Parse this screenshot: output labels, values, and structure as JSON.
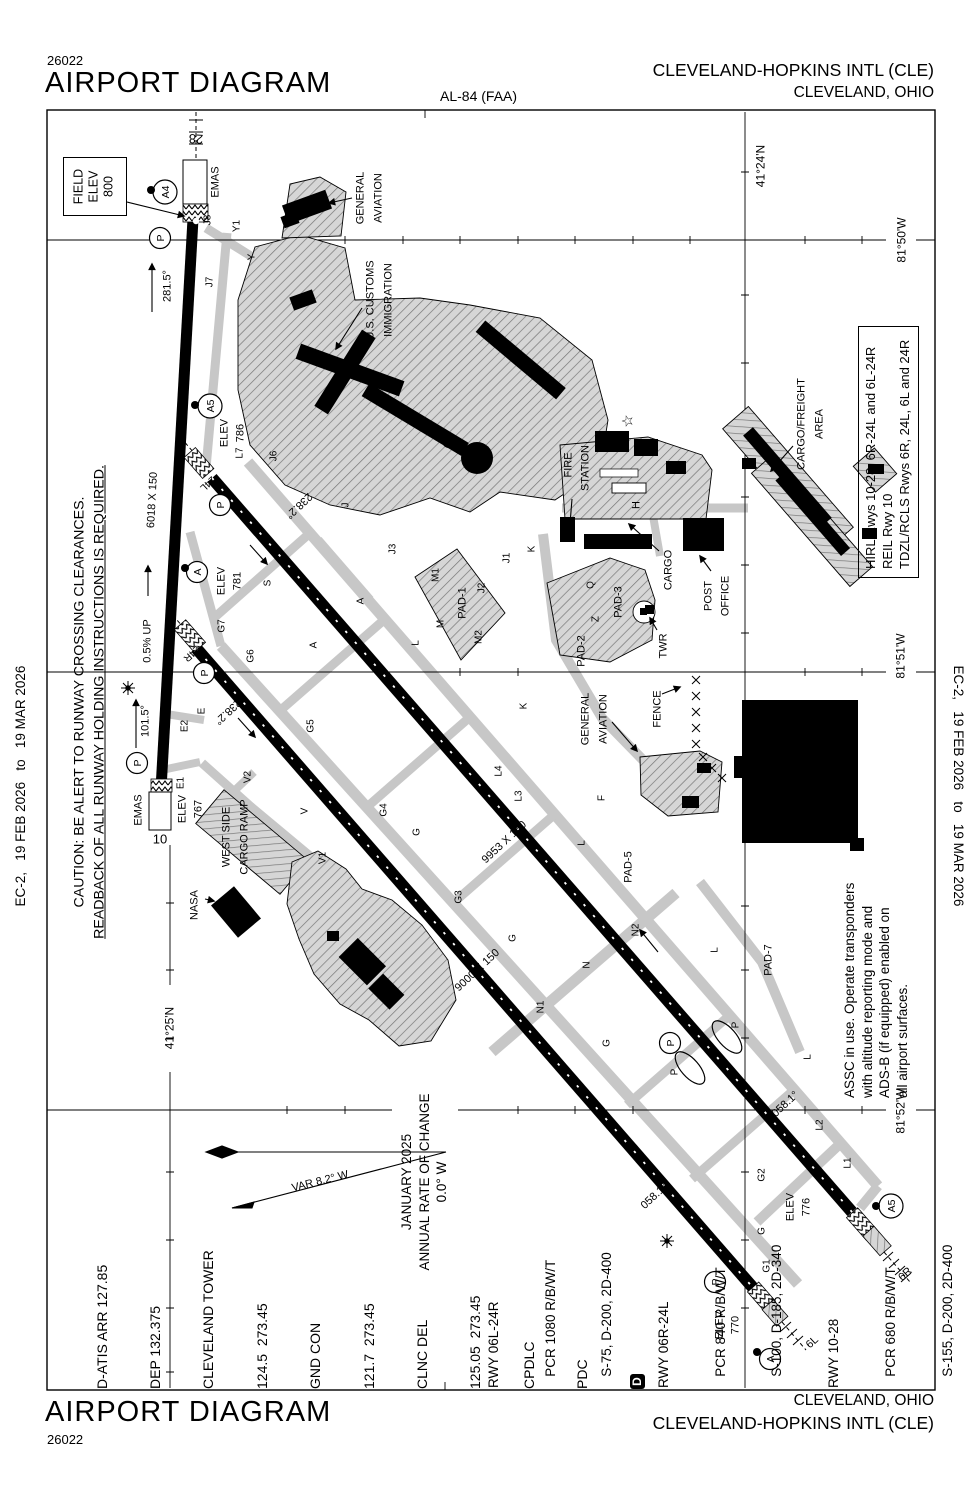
{
  "header": {
    "cycle": "26022",
    "title": "AIRPORT DIAGRAM",
    "chart_code": "AL-84 (FAA)",
    "airport_name": "CLEVELAND-HOPKINS INTL (CLE)",
    "city": "CLEVELAND, OHIO"
  },
  "footer": {
    "title": "AIRPORT DIAGRAM",
    "cycle": "26022",
    "city": "CLEVELAND, OHIO",
    "airport_name": "CLEVELAND-HOPKINS INTL (CLE)"
  },
  "margins": {
    "left": "EC-2,   19 FEB 2026   to   19 MAR 2026",
    "right": "EC-2,   19 FEB 2026   to   19 MAR 2026"
  },
  "caution": {
    "line1": "CAUTION: BE ALERT TO RUNWAY CROSSING CLEARANCES.",
    "line2": "READBACK OF ALL RUNWAY HOLDING INSTRUCTIONS IS REQUIRED."
  },
  "field_elev": {
    "line1": "FIELD",
    "line2": "ELEV",
    "value": "800"
  },
  "comm": {
    "lines": [
      "D-ATIS ARR 127.85",
      "DEP 132.375",
      "CLEVELAND TOWER",
      "124.5  273.45",
      "GND CON",
      "121.7  273.45",
      "CLNC DEL",
      "125.05  273.45",
      "CPDLC",
      "PDC"
    ],
    "pdc_symbol": "D"
  },
  "runway_data": {
    "lines": [
      "RWY 06L-24R",
      "   PCR 1080 R/B/W/T",
      "   S-75, D-200, 2D-400",
      "RWY 06R-24L",
      "   PCR 840 R/B/W/T",
      "   S-100, D-185, 2D-340",
      "RWY 10-28",
      "   PCR 680 R/B/W/T",
      "   S-155, D-200, 2D-400"
    ]
  },
  "lighting_box": {
    "lines": [
      "HIRL Rwys 10-28, 6R-24L and 6L-24R",
      "REIL Rwy 10",
      "TDZL/RCLS Rwys 6R, 24L, 6L and 24R"
    ]
  },
  "assc_note": {
    "lines": [
      "ASSC in use. Operate transponders",
      "with altitude reporting mode and",
      "ADS-B (if equipped) enabled on",
      "all airport surfaces."
    ]
  },
  "variation": {
    "january": "JANUARY 2025",
    "rate": "ANNUAL RATE OF CHANGE",
    "value": "0.0° W"
  },
  "map": {
    "labels": [
      {
        "n": "rwy-28-number",
        "t": "28",
        "x": 196,
        "y": 138,
        "r": 183,
        "s": 13
      },
      {
        "n": "emas-28-label",
        "t": "EMAS",
        "x": 215,
        "y": 182,
        "r": -90,
        "s": 11
      },
      {
        "t": "J8",
        "x": 207,
        "y": 220,
        "r": -90,
        "s": 10
      },
      {
        "t": "Y1",
        "x": 236,
        "y": 226,
        "r": -90,
        "s": 10
      },
      {
        "t": "Y",
        "x": 251,
        "y": 257,
        "r": -90,
        "s": 10
      },
      {
        "t": "J7",
        "x": 209,
        "y": 282,
        "r": -90,
        "s": 10
      },
      {
        "n": "rwy-28-heading",
        "t": "281.5°",
        "x": 167,
        "y": 286,
        "r": -90,
        "s": 11
      },
      {
        "t": "GENERAL",
        "x": 360,
        "y": 198,
        "r": -90,
        "s": 11
      },
      {
        "t": "AVIATION",
        "x": 378,
        "y": 198,
        "r": -90,
        "s": 11
      },
      {
        "t": "U.S. CUSTOMS",
        "x": 370,
        "y": 300,
        "r": -90,
        "s": 11
      },
      {
        "t": "IMMIGRATION",
        "x": 388,
        "y": 300,
        "r": -90,
        "s": 11
      },
      {
        "n": "lat-41-24",
        "t": "41°24'N",
        "x": 761,
        "y": 166,
        "r": -90,
        "s": 12
      },
      {
        "n": "lon-81-50",
        "t": "81°50'W",
        "x": 902,
        "y": 240,
        "r": -90,
        "s": 12
      },
      {
        "t": "ELEV",
        "x": 224,
        "y": 433,
        "r": -90,
        "s": 11
      },
      {
        "t": "786",
        "x": 240,
        "y": 433,
        "r": -90,
        "s": 11
      },
      {
        "t": "L7",
        "x": 239,
        "y": 453,
        "r": -90,
        "s": 10
      },
      {
        "n": "rwy-24l-number",
        "t": "24L",
        "x": 208,
        "y": 484,
        "r": 137,
        "s": 10
      },
      {
        "t": "J6",
        "x": 273,
        "y": 456,
        "r": -90,
        "s": 10
      },
      {
        "t": "J",
        "x": 345,
        "y": 505,
        "r": -90,
        "s": 10
      },
      {
        "t": "J3",
        "x": 392,
        "y": 549,
        "r": -90,
        "s": 10
      },
      {
        "t": "J1",
        "x": 506,
        "y": 558,
        "r": -90,
        "s": 10
      },
      {
        "t": "J2",
        "x": 481,
        "y": 588,
        "r": -90,
        "s": 10
      },
      {
        "t": "K",
        "x": 531,
        "y": 549,
        "r": -90,
        "s": 10
      },
      {
        "t": "K",
        "x": 523,
        "y": 706,
        "r": -90,
        "s": 10
      },
      {
        "t": "M1",
        "x": 435,
        "y": 575,
        "r": -90,
        "s": 10
      },
      {
        "t": "PAD-1",
        "x": 462,
        "y": 603,
        "r": -90,
        "s": 11
      },
      {
        "t": "M",
        "x": 440,
        "y": 624,
        "r": -90,
        "s": 10
      },
      {
        "t": "M2",
        "x": 478,
        "y": 637,
        "r": -90,
        "s": 10
      },
      {
        "t": "L",
        "x": 415,
        "y": 643,
        "r": -90,
        "s": 10
      },
      {
        "n": "rwy-24l-heading",
        "t": "238.2°",
        "x": 299,
        "y": 506,
        "r": 137,
        "s": 11
      },
      {
        "t": "S",
        "x": 267,
        "y": 583,
        "r": -90,
        "s": 10
      },
      {
        "t": "ELEV",
        "x": 221,
        "y": 581,
        "r": -90,
        "s": 11
      },
      {
        "t": "781",
        "x": 237,
        "y": 581,
        "r": -90,
        "s": 11
      },
      {
        "t": "A",
        "x": 313,
        "y": 645,
        "r": -90,
        "s": 10
      },
      {
        "t": "A",
        "x": 360,
        "y": 601,
        "r": -90,
        "s": 10
      },
      {
        "t": "G7",
        "x": 221,
        "y": 626,
        "r": -90,
        "s": 10
      },
      {
        "n": "rwy-24r-number",
        "t": "24R",
        "x": 192,
        "y": 654,
        "r": 137,
        "s": 10
      },
      {
        "t": "G6",
        "x": 250,
        "y": 656,
        "r": -90,
        "s": 10
      },
      {
        "t": "E2",
        "x": 184,
        "y": 726,
        "r": -90,
        "s": 10
      },
      {
        "t": "E",
        "x": 201,
        "y": 711,
        "r": -90,
        "s": 10
      },
      {
        "n": "rwy-24r-heading",
        "t": "238.2°",
        "x": 228,
        "y": 712,
        "r": 137,
        "s": 11
      },
      {
        "t": "G5",
        "x": 310,
        "y": 726,
        "r": -90,
        "s": 10
      },
      {
        "n": "slope-label",
        "t": "0.5% UP",
        "x": 147,
        "y": 641,
        "r": -90,
        "s": 11
      },
      {
        "n": "rwy-10-heading",
        "t": "101.5°",
        "x": 145,
        "y": 721,
        "r": -90,
        "s": 11
      },
      {
        "t": "E1",
        "x": 180,
        "y": 783,
        "r": -90,
        "s": 10
      },
      {
        "n": "emas-10-label",
        "t": "EMAS",
        "x": 138,
        "y": 810,
        "r": -90,
        "s": 11
      },
      {
        "n": "rwy-10-number",
        "t": "10",
        "x": 160,
        "y": 840,
        "r": 0,
        "s": 13
      },
      {
        "t": "ELEV",
        "x": 182,
        "y": 809,
        "r": -90,
        "s": 11
      },
      {
        "t": "767",
        "x": 198,
        "y": 809,
        "r": -90,
        "s": 11
      },
      {
        "t": "V2",
        "x": 247,
        "y": 777,
        "r": -90,
        "s": 10
      },
      {
        "t": "WEST SIDE",
        "x": 226,
        "y": 837,
        "r": -90,
        "s": 11
      },
      {
        "t": "CARGO RAMP",
        "x": 244,
        "y": 837,
        "r": -90,
        "s": 11
      },
      {
        "t": "V",
        "x": 304,
        "y": 811,
        "r": -90,
        "s": 10
      },
      {
        "t": "V1",
        "x": 322,
        "y": 858,
        "r": -90,
        "s": 10
      },
      {
        "t": "NASA",
        "x": 194,
        "y": 905,
        "r": -90,
        "s": 11
      },
      {
        "n": "lat-41-25",
        "t": "41°25'N",
        "x": 170,
        "y": 1028,
        "r": -90,
        "s": 12
      },
      {
        "t": "G4",
        "x": 383,
        "y": 810,
        "r": -90,
        "s": 10
      },
      {
        "t": "G",
        "x": 416,
        "y": 832,
        "r": -90,
        "s": 10
      },
      {
        "t": "G3",
        "x": 458,
        "y": 897,
        "r": -90,
        "s": 10
      },
      {
        "t": "G",
        "x": 512,
        "y": 938,
        "r": -90,
        "s": 10
      },
      {
        "n": "rwy-6l24r-dim",
        "t": "9000 X 150",
        "x": 477,
        "y": 970,
        "r": -43,
        "s": 11
      },
      {
        "n": "rwy-6r24l-dim",
        "t": "9953 X 150",
        "x": 504,
        "y": 842,
        "r": -43,
        "s": 11
      },
      {
        "n": "rwy-1028-dim",
        "t": "6018 X 150",
        "x": 152,
        "y": 500,
        "r": -87,
        "s": 11
      },
      {
        "t": "L4",
        "x": 498,
        "y": 771,
        "r": -90,
        "s": 10
      },
      {
        "t": "L3",
        "x": 518,
        "y": 796,
        "r": -90,
        "s": 10
      },
      {
        "t": "L",
        "x": 581,
        "y": 843,
        "r": -90,
        "s": 10
      },
      {
        "t": "F",
        "x": 601,
        "y": 798,
        "r": -90,
        "s": 10
      },
      {
        "t": "Q",
        "x": 590,
        "y": 585,
        "r": -90,
        "s": 10
      },
      {
        "t": "Z",
        "x": 595,
        "y": 619,
        "r": -90,
        "s": 10
      },
      {
        "t": "PAD-3",
        "x": 618,
        "y": 602,
        "r": -90,
        "s": 11
      },
      {
        "t": "PAD-2",
        "x": 581,
        "y": 651,
        "r": -90,
        "s": 11
      },
      {
        "t": "CARGO",
        "x": 668,
        "y": 570,
        "r": -90,
        "s": 11
      },
      {
        "t": "TWR",
        "x": 663,
        "y": 646,
        "r": -90,
        "s": 11
      },
      {
        "t": "POST",
        "x": 708,
        "y": 596,
        "r": -90,
        "s": 11
      },
      {
        "t": "OFFICE",
        "x": 725,
        "y": 596,
        "r": -90,
        "s": 11
      },
      {
        "t": "FIRE",
        "x": 568,
        "y": 465,
        "r": -90,
        "s": 11
      },
      {
        "t": "STATION",
        "x": 585,
        "y": 468,
        "r": -90,
        "s": 11
      },
      {
        "t": "H",
        "x": 636,
        "y": 505,
        "r": -90,
        "s": 11
      },
      {
        "t": "CARGO/FREIGHT",
        "x": 801,
        "y": 424,
        "r": -90,
        "s": 11
      },
      {
        "t": "AREA",
        "x": 819,
        "y": 424,
        "r": -90,
        "s": 11
      },
      {
        "t": "GENERAL",
        "x": 585,
        "y": 719,
        "r": -90,
        "s": 11
      },
      {
        "t": "AVIATION",
        "x": 603,
        "y": 719,
        "r": -90,
        "s": 11
      },
      {
        "t": "FENCE",
        "x": 657,
        "y": 709,
        "r": -90,
        "s": 11
      },
      {
        "t": "PAD-5",
        "x": 628,
        "y": 867,
        "r": -90,
        "s": 11
      },
      {
        "t": "PAD-7",
        "x": 768,
        "y": 960,
        "r": -90,
        "s": 11
      },
      {
        "t": "N1",
        "x": 540,
        "y": 1007,
        "r": -90,
        "s": 10
      },
      {
        "t": "N",
        "x": 586,
        "y": 965,
        "r": -90,
        "s": 10
      },
      {
        "t": "N2",
        "x": 635,
        "y": 930,
        "r": -90,
        "s": 10
      },
      {
        "t": "L",
        "x": 714,
        "y": 950,
        "r": -90,
        "s": 10
      },
      {
        "t": "L",
        "x": 807,
        "y": 1057,
        "r": -90,
        "s": 10
      },
      {
        "t": "G",
        "x": 606,
        "y": 1043,
        "r": -90,
        "s": 10
      },
      {
        "t": "P",
        "x": 735,
        "y": 1025,
        "r": -90,
        "s": 10
      },
      {
        "t": "P",
        "x": 674,
        "y": 1072,
        "r": -90,
        "s": 10
      },
      {
        "n": "rwy-6r-heading",
        "t": "058.1°",
        "x": 785,
        "y": 1104,
        "r": -43,
        "s": 11
      },
      {
        "t": "L2",
        "x": 819,
        "y": 1125,
        "r": -90,
        "s": 10
      },
      {
        "t": "L1",
        "x": 847,
        "y": 1163,
        "r": -90,
        "s": 10
      },
      {
        "n": "lon-81-52",
        "t": "81°52'W",
        "x": 901,
        "y": 1111,
        "r": -90,
        "s": 12
      },
      {
        "t": "G2",
        "x": 761,
        "y": 1175,
        "r": -90,
        "s": 10
      },
      {
        "t": "ELEV",
        "x": 790,
        "y": 1207,
        "r": -90,
        "s": 11
      },
      {
        "t": "776",
        "x": 806,
        "y": 1207,
        "r": -90,
        "s": 11
      },
      {
        "t": "G",
        "x": 761,
        "y": 1231,
        "r": -90,
        "s": 10
      },
      {
        "t": "G1",
        "x": 766,
        "y": 1266,
        "r": -90,
        "s": 10
      },
      {
        "n": "rwy-6r-number",
        "t": "6R",
        "x": 905,
        "y": 1274,
        "r": -43,
        "s": 11
      },
      {
        "n": "rwy-6l-heading",
        "t": "058.1°",
        "x": 654,
        "y": 1196,
        "r": -43,
        "s": 11
      },
      {
        "t": "ELEV",
        "x": 719,
        "y": 1325,
        "r": -90,
        "s": 11
      },
      {
        "t": "770",
        "x": 735,
        "y": 1325,
        "r": -90,
        "s": 11
      },
      {
        "n": "rwy-6l-number",
        "t": "6L",
        "x": 812,
        "y": 1342,
        "r": -43,
        "s": 11
      },
      {
        "n": "lon-81-51",
        "t": "81°51'W",
        "x": 901,
        "y": 656,
        "r": -90,
        "s": 12
      },
      {
        "n": "var-label",
        "t": "VAR 8.2°  W",
        "x": 320,
        "y": 1181,
        "r": -14,
        "s": 11
      },
      {
        "n": "beacon-star",
        "t": "☆",
        "x": 629,
        "y": 421,
        "r": -90,
        "s": 15
      }
    ],
    "circled": [
      {
        "t": "A4",
        "x": 165,
        "y": 192
      },
      {
        "t": "P",
        "x": 160,
        "y": 238
      },
      {
        "t": "A5",
        "x": 210,
        "y": 406
      },
      {
        "t": "P",
        "x": 220,
        "y": 505
      },
      {
        "t": "A",
        "x": 197,
        "y": 572
      },
      {
        "t": "P",
        "x": 204,
        "y": 673
      },
      {
        "t": "P",
        "x": 137,
        "y": 763
      },
      {
        "t": "P",
        "x": 670,
        "y": 1043
      },
      {
        "t": "P",
        "x": 715,
        "y": 1282
      },
      {
        "t": "A",
        "x": 770,
        "y": 1359
      },
      {
        "t": "A5",
        "x": 891,
        "y": 1206
      }
    ],
    "dots": [
      {
        "x": 151,
        "y": 190
      },
      {
        "x": 195,
        "y": 405
      },
      {
        "x": 185,
        "y": 568
      },
      {
        "x": 876,
        "y": 1206
      },
      {
        "x": 757,
        "y": 1352
      }
    ]
  }
}
